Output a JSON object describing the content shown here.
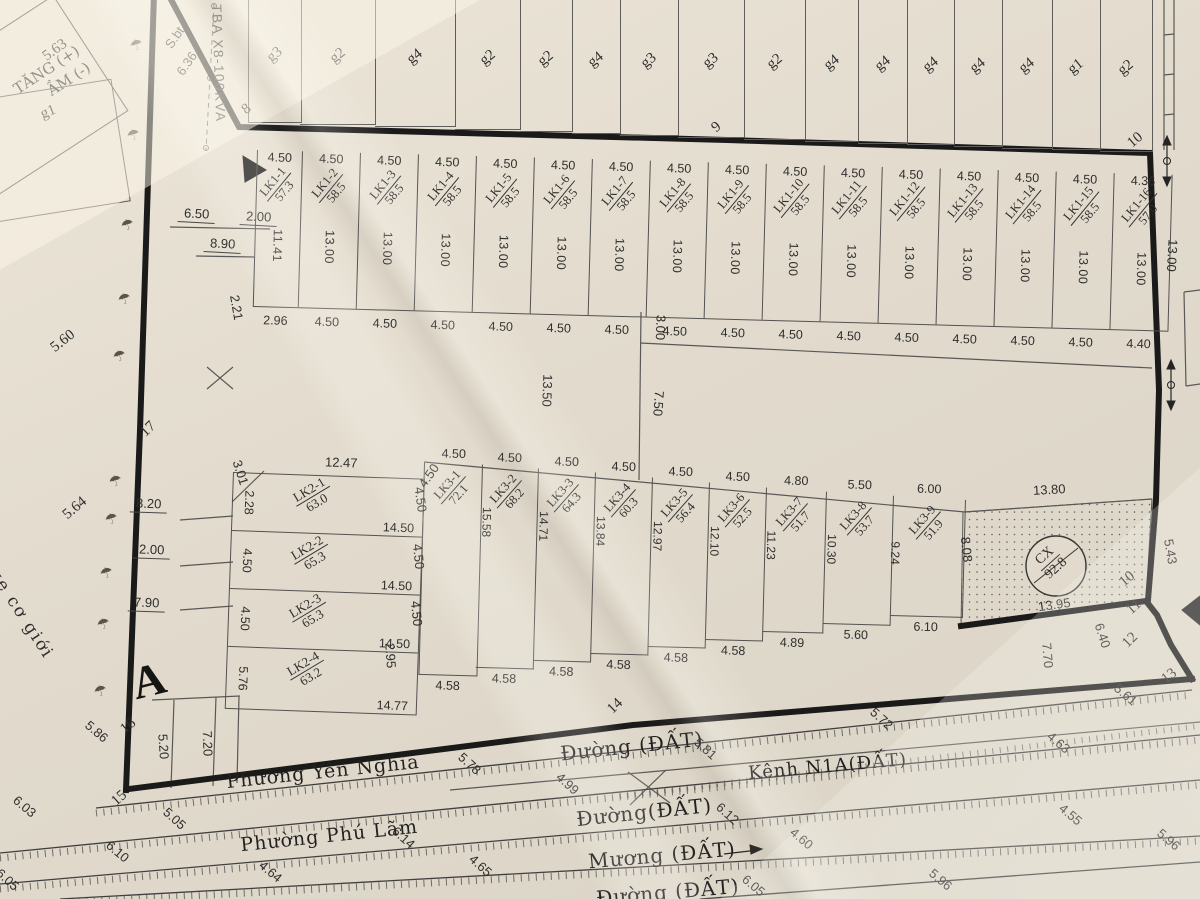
{
  "block_label": "A",
  "tree_glyph": "☂",
  "colors": {
    "paper": "#ded9d0",
    "ink": "#161616",
    "thin_line": "#555555"
  },
  "top_strip": {
    "labels": [
      "g3",
      "g2",
      "g4",
      "g2",
      "g2",
      "g4",
      "g3",
      "g3",
      "g2",
      "g4",
      "g4",
      "g4",
      "g4",
      "g4",
      "g1",
      "g2"
    ]
  },
  "lk1": {
    "lots": [
      {
        "id": "LK1-1",
        "area": "57.3",
        "top": "4.50",
        "depth": "11.41",
        "bottom": "2.96"
      },
      {
        "id": "LK1-2",
        "area": "58.5",
        "top": "4.50",
        "depth": "13.00",
        "bottom": "4.50"
      },
      {
        "id": "LK1-3",
        "area": "58.5",
        "top": "4.50",
        "depth": "13.00",
        "bottom": "4.50"
      },
      {
        "id": "LK1-4",
        "area": "58.5",
        "top": "4.50",
        "depth": "13.00",
        "bottom": "4.50"
      },
      {
        "id": "LK1-5",
        "area": "58.5",
        "top": "4.50",
        "depth": "13.00",
        "bottom": "4.50"
      },
      {
        "id": "LK1-6",
        "area": "58.5",
        "top": "4.50",
        "depth": "13.00",
        "bottom": "4.50"
      },
      {
        "id": "LK1-7",
        "area": "58.5",
        "top": "4.50",
        "depth": "13.00",
        "bottom": "4.50"
      },
      {
        "id": "LK1-8",
        "area": "58.5",
        "top": "4.50",
        "depth": "13.00",
        "bottom": "4.50"
      },
      {
        "id": "LK1-9",
        "area": "58.5",
        "top": "4.50",
        "depth": "13.00",
        "bottom": "4.50"
      },
      {
        "id": "LK1-10",
        "area": "58.5",
        "top": "4.50",
        "depth": "13.00",
        "bottom": "4.50"
      },
      {
        "id": "LK1-11",
        "area": "58.5",
        "top": "4.50",
        "depth": "13.00",
        "bottom": "4.50"
      },
      {
        "id": "LK1-12",
        "area": "58.5",
        "top": "4.50",
        "depth": "13.00",
        "bottom": "4.50"
      },
      {
        "id": "LK1-13",
        "area": "58.5",
        "top": "4.50",
        "depth": "13.00",
        "bottom": "4.50"
      },
      {
        "id": "LK1-14",
        "area": "58.5",
        "top": "4.50",
        "depth": "13.00",
        "bottom": "4.50"
      },
      {
        "id": "LK1-15",
        "area": "58.5",
        "top": "4.50",
        "depth": "13.00",
        "bottom": "4.50"
      },
      {
        "id": "LK1-16",
        "area": "57.0",
        "top": "4.36",
        "depth": "13.00",
        "bottom": "4.40"
      }
    ]
  },
  "lk2": {
    "lots": [
      {
        "id": "LK2-1",
        "area": "63.0",
        "left": "2.28",
        "bottom": "14.50"
      },
      {
        "id": "LK2-2",
        "area": "65.3",
        "left": "4.50",
        "bottom": "14.50"
      },
      {
        "id": "LK2-3",
        "area": "65.3",
        "left": "4.50",
        "bottom": "14.50"
      },
      {
        "id": "LK2-4",
        "area": "63.2",
        "left": "5.76",
        "bottom": "14.77"
      }
    ]
  },
  "lk3": {
    "lots": [
      {
        "id": "LK3-1",
        "area": "72.1",
        "top": "4.50",
        "depth": "",
        "bottom": "4.58"
      },
      {
        "id": "LK3-2",
        "area": "68.2",
        "top": "4.50",
        "depth": "15.58",
        "bottom": "4.58"
      },
      {
        "id": "LK3-3",
        "area": "64.3",
        "top": "4.50",
        "depth": "14.71",
        "bottom": "4.58"
      },
      {
        "id": "LK3-4",
        "area": "60.3",
        "top": "4.50",
        "depth": "13.84",
        "bottom": "4.58"
      },
      {
        "id": "LK3-5",
        "area": "56.4",
        "top": "4.50",
        "depth": "12.97",
        "bottom": "4.58"
      },
      {
        "id": "LK3-6",
        "area": "52.5",
        "top": "4.50",
        "depth": "12.10",
        "bottom": "4.58"
      },
      {
        "id": "LK3-7",
        "area": "51.7",
        "top": "4.80",
        "depth": "11.23",
        "bottom": "4.89"
      },
      {
        "id": "LK3-8",
        "area": "53.7",
        "top": "5.50",
        "depth": "10.30",
        "bottom": "5.60"
      },
      {
        "id": "LK3-9",
        "area": "51.9",
        "top": "6.00",
        "depth": "9.24",
        "bottom": "6.10"
      }
    ]
  },
  "cx": {
    "name": "CX",
    "area": "92.8"
  },
  "tl": {
    "building_line1": "TĂNG (+)",
    "building_line2": "ẦM (-)",
    "g1": "g1",
    "tba": "TBA X8-100KVA",
    "road_left": "xe cơ giới"
  },
  "roads": [
    {
      "name": "Phường Yên Nghĩa",
      "x": 226,
      "y": 761,
      "r": -6,
      "s": 19
    },
    {
      "name": "Đường  (ĐẤT)",
      "x": 560,
      "y": 734,
      "r": -6,
      "s": 20
    },
    {
      "name": "Kênh N1A(ĐẤT)",
      "x": 748,
      "y": 756,
      "r": -5,
      "s": 18
    },
    {
      "name": "Phường Phú Lãm",
      "x": 240,
      "y": 825,
      "r": -6,
      "s": 19
    },
    {
      "name": "Đường(ĐẤT)",
      "x": 576,
      "y": 800,
      "r": -6,
      "s": 20
    },
    {
      "name": "Mương (ĐẤT)",
      "x": 588,
      "y": 843,
      "r": -5,
      "s": 20
    },
    {
      "name": "Đường (ĐẤT)",
      "x": 596,
      "y": 880,
      "r": -5,
      "s": 20
    }
  ],
  "scatter": [
    {
      "t": "S.bt",
      "x": 163,
      "y": 30,
      "r": -55
    },
    {
      "t": "6.36",
      "x": 174,
      "y": 56,
      "r": -55
    },
    {
      "t": "5.63",
      "x": 42,
      "y": 42,
      "r": -36,
      "c": "pt"
    },
    {
      "t": "8",
      "x": 243,
      "y": 101,
      "r": -38,
      "c": "pt"
    },
    {
      "t": "9",
      "x": 713,
      "y": 119,
      "r": -40,
      "c": "pt"
    },
    {
      "t": "10",
      "x": 1128,
      "y": 132,
      "r": -40,
      "c": "pt"
    },
    {
      "t": "13.00",
      "x": 1156,
      "y": 248,
      "r": 93
    },
    {
      "t": "6.50",
      "x": 178,
      "y": 206,
      "r": 3,
      "c": "ul"
    },
    {
      "t": "2.00",
      "x": 240,
      "y": 209,
      "r": 3,
      "c": "ul"
    },
    {
      "t": "8.90",
      "x": 204,
      "y": 236,
      "r": 3,
      "c": "ul"
    },
    {
      "t": "2.21",
      "x": 224,
      "y": 300,
      "r": 80
    },
    {
      "t": "5.60",
      "x": 50,
      "y": 333,
      "r": -38,
      "c": "pt"
    },
    {
      "t": "17",
      "x": 141,
      "y": 421,
      "r": -44,
      "c": "pt"
    },
    {
      "t": "5.64",
      "x": 62,
      "y": 500,
      "r": -40,
      "c": "pt"
    },
    {
      "t": "13.50",
      "x": 531,
      "y": 383,
      "r": 92
    },
    {
      "t": "3.00",
      "x": 648,
      "y": 320,
      "r": 92
    },
    {
      "t": "7.50",
      "x": 646,
      "y": 396,
      "r": 94
    },
    {
      "t": "12.47",
      "x": 325,
      "y": 455,
      "r": 2
    },
    {
      "t": "3.01",
      "x": 228,
      "y": 465,
      "r": 72
    },
    {
      "t": "8.20",
      "x": 130,
      "y": 496,
      "r": 2,
      "c": "ul"
    },
    {
      "t": "2.00",
      "x": 133,
      "y": 542,
      "r": 2,
      "c": "ul"
    },
    {
      "t": "7.90",
      "x": 128,
      "y": 595,
      "r": 2,
      "c": "ul"
    },
    {
      "t": "4.50",
      "x": 416,
      "y": 468,
      "r": -55
    },
    {
      "t": "4.50",
      "x": 408,
      "y": 492,
      "r": 82
    },
    {
      "t": "4.50",
      "x": 406,
      "y": 549,
      "r": 84
    },
    {
      "t": "4.50",
      "x": 404,
      "y": 606,
      "r": 84
    },
    {
      "t": "2.95",
      "x": 378,
      "y": 648,
      "r": 86
    },
    {
      "t": "8.08",
      "x": 954,
      "y": 542,
      "r": 84
    },
    {
      "t": "13.80",
      "x": 1033,
      "y": 482,
      "r": -3
    },
    {
      "t": "13.95",
      "x": 1038,
      "y": 597,
      "r": -8
    },
    {
      "t": "5.43",
      "x": 1158,
      "y": 544,
      "r": 80
    },
    {
      "t": "10",
      "x": 1120,
      "y": 571,
      "r": -40,
      "c": "pt"
    },
    {
      "t": "11",
      "x": 1127,
      "y": 599,
      "r": -42,
      "c": "pt"
    },
    {
      "t": "12",
      "x": 1123,
      "y": 632,
      "r": -45,
      "c": "pt"
    },
    {
      "t": "13",
      "x": 1162,
      "y": 668,
      "r": -38,
      "c": "pt"
    },
    {
      "t": "6.40",
      "x": 1090,
      "y": 628,
      "r": 72
    },
    {
      "t": "7.70",
      "x": 1035,
      "y": 648,
      "r": 85
    },
    {
      "t": "14",
      "x": 608,
      "y": 698,
      "r": -44,
      "c": "pt"
    },
    {
      "t": "16",
      "x": 121,
      "y": 718,
      "r": -40,
      "c": "pt"
    },
    {
      "t": "5.20",
      "x": 151,
      "y": 739,
      "r": 86
    },
    {
      "t": "7.20",
      "x": 195,
      "y": 736,
      "r": 88
    },
    {
      "t": "15",
      "x": 112,
      "y": 790,
      "r": -42,
      "c": "pt"
    },
    {
      "t": "5.86",
      "x": 84,
      "y": 724,
      "r": 40
    },
    {
      "t": "6.03",
      "x": 12,
      "y": 799,
      "r": 40
    },
    {
      "t": "5.05",
      "x": 162,
      "y": 811,
      "r": 42
    },
    {
      "t": "6.10",
      "x": 105,
      "y": 844,
      "r": 40
    },
    {
      "t": "6.05",
      "x": -5,
      "y": 872,
      "r": 42
    },
    {
      "t": "4.64",
      "x": 258,
      "y": 864,
      "r": 40
    },
    {
      "t": "6.14",
      "x": 391,
      "y": 830,
      "r": 42
    },
    {
      "t": "4.65",
      "x": 468,
      "y": 858,
      "r": 42
    },
    {
      "t": "5.78",
      "x": 457,
      "y": 756,
      "r": 42
    },
    {
      "t": "4.99",
      "x": 555,
      "y": 776,
      "r": 42
    },
    {
      "t": "5.81",
      "x": 693,
      "y": 741,
      "r": 42
    },
    {
      "t": "6.12",
      "x": 715,
      "y": 806,
      "r": 42
    },
    {
      "t": "4.60",
      "x": 789,
      "y": 831,
      "r": 40
    },
    {
      "t": "6.05",
      "x": 741,
      "y": 878,
      "r": 40
    },
    {
      "t": "5.72",
      "x": 869,
      "y": 711,
      "r": 42
    },
    {
      "t": "5.61",
      "x": 1113,
      "y": 687,
      "r": 40
    },
    {
      "t": "4.63",
      "x": 1046,
      "y": 735,
      "r": 40
    },
    {
      "t": "4.55",
      "x": 1058,
      "y": 807,
      "r": 40
    },
    {
      "t": "5.96",
      "x": 1156,
      "y": 832,
      "r": 40
    },
    {
      "t": "5.96",
      "x": 928,
      "y": 872,
      "r": 40
    }
  ],
  "trees": [
    [
      130,
      36
    ],
    [
      127,
      126
    ],
    [
      121,
      216
    ],
    [
      118,
      290
    ],
    [
      113,
      347
    ],
    [
      109,
      472
    ],
    [
      105,
      510
    ],
    [
      100,
      564
    ],
    [
      97,
      615
    ],
    [
      94,
      682
    ]
  ]
}
